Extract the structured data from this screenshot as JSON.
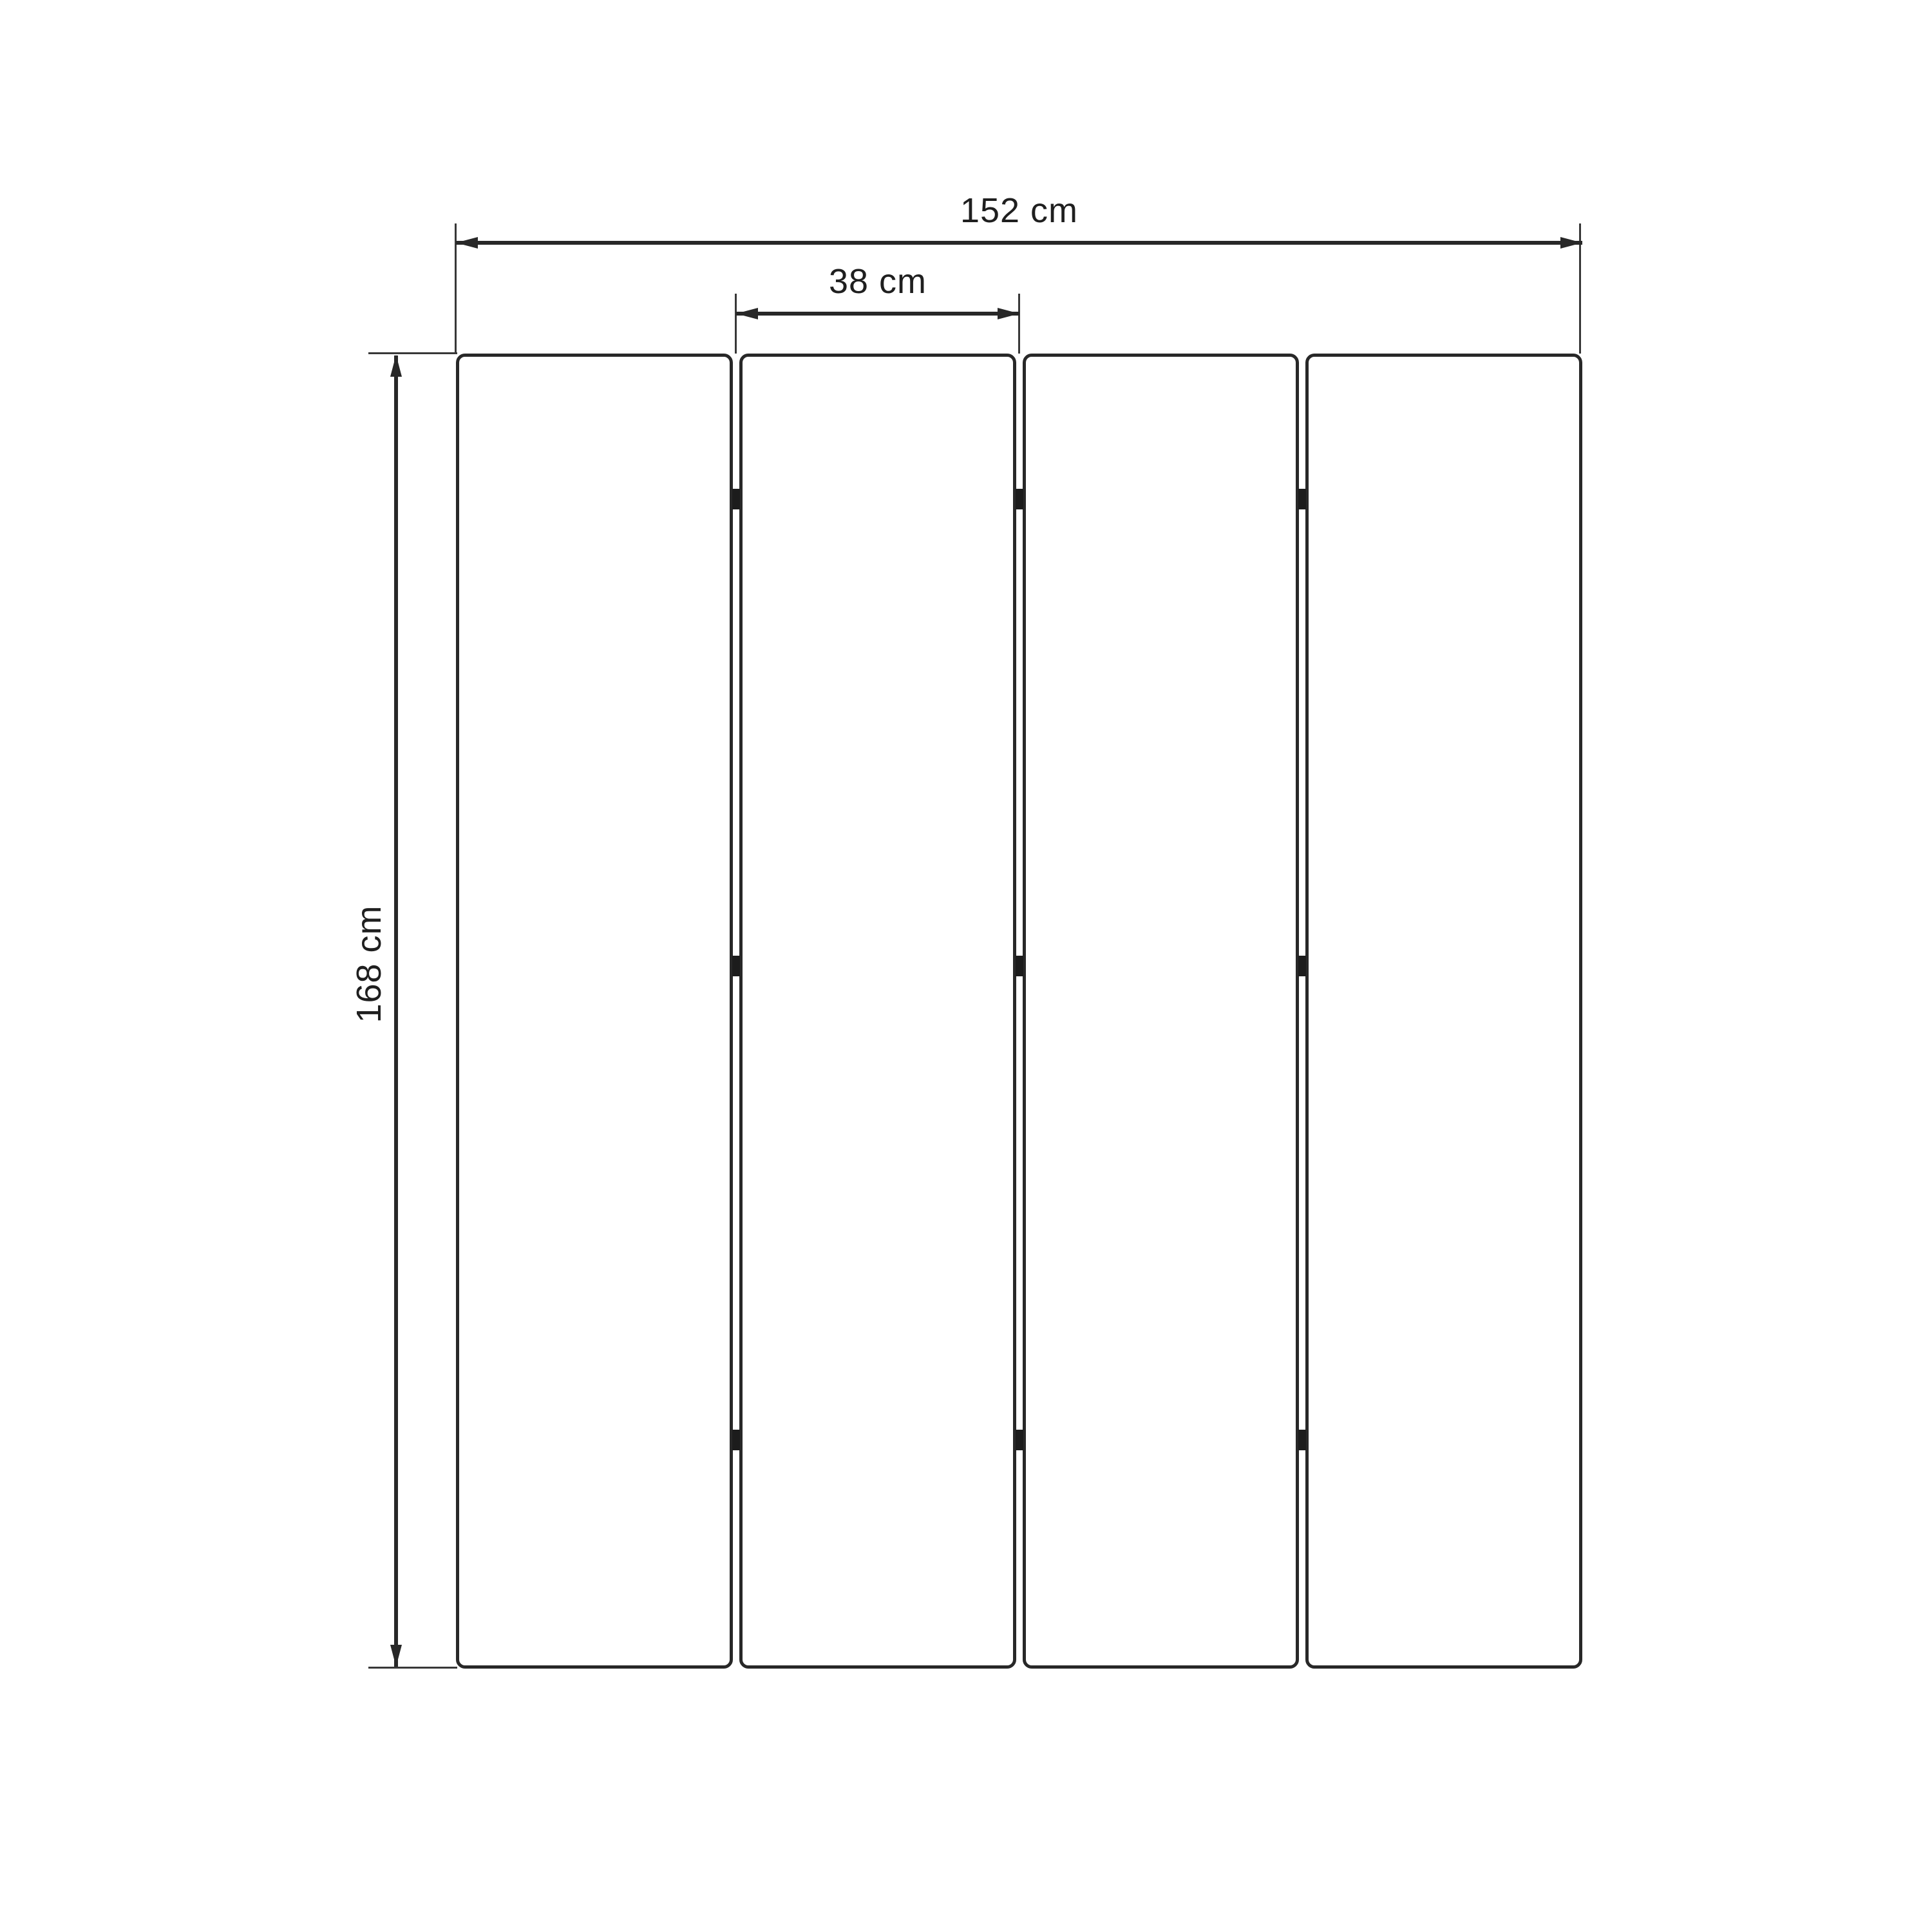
{
  "diagram": {
    "type": "furniture-dimension-diagram",
    "subject": "four-panel folding screen, front view"
  },
  "dimensions": {
    "width_total": "152 cm",
    "panel_width": "38 cm",
    "height": "168 cm"
  },
  "panels": {
    "count": 4
  },
  "hinges": {
    "rows": 3,
    "gaps": 3
  },
  "colors": {
    "line": "#282828",
    "thin": "#383838",
    "hinge": "#1c1c1c",
    "background": "#ffffff",
    "panel_fill": "#ffffff"
  }
}
